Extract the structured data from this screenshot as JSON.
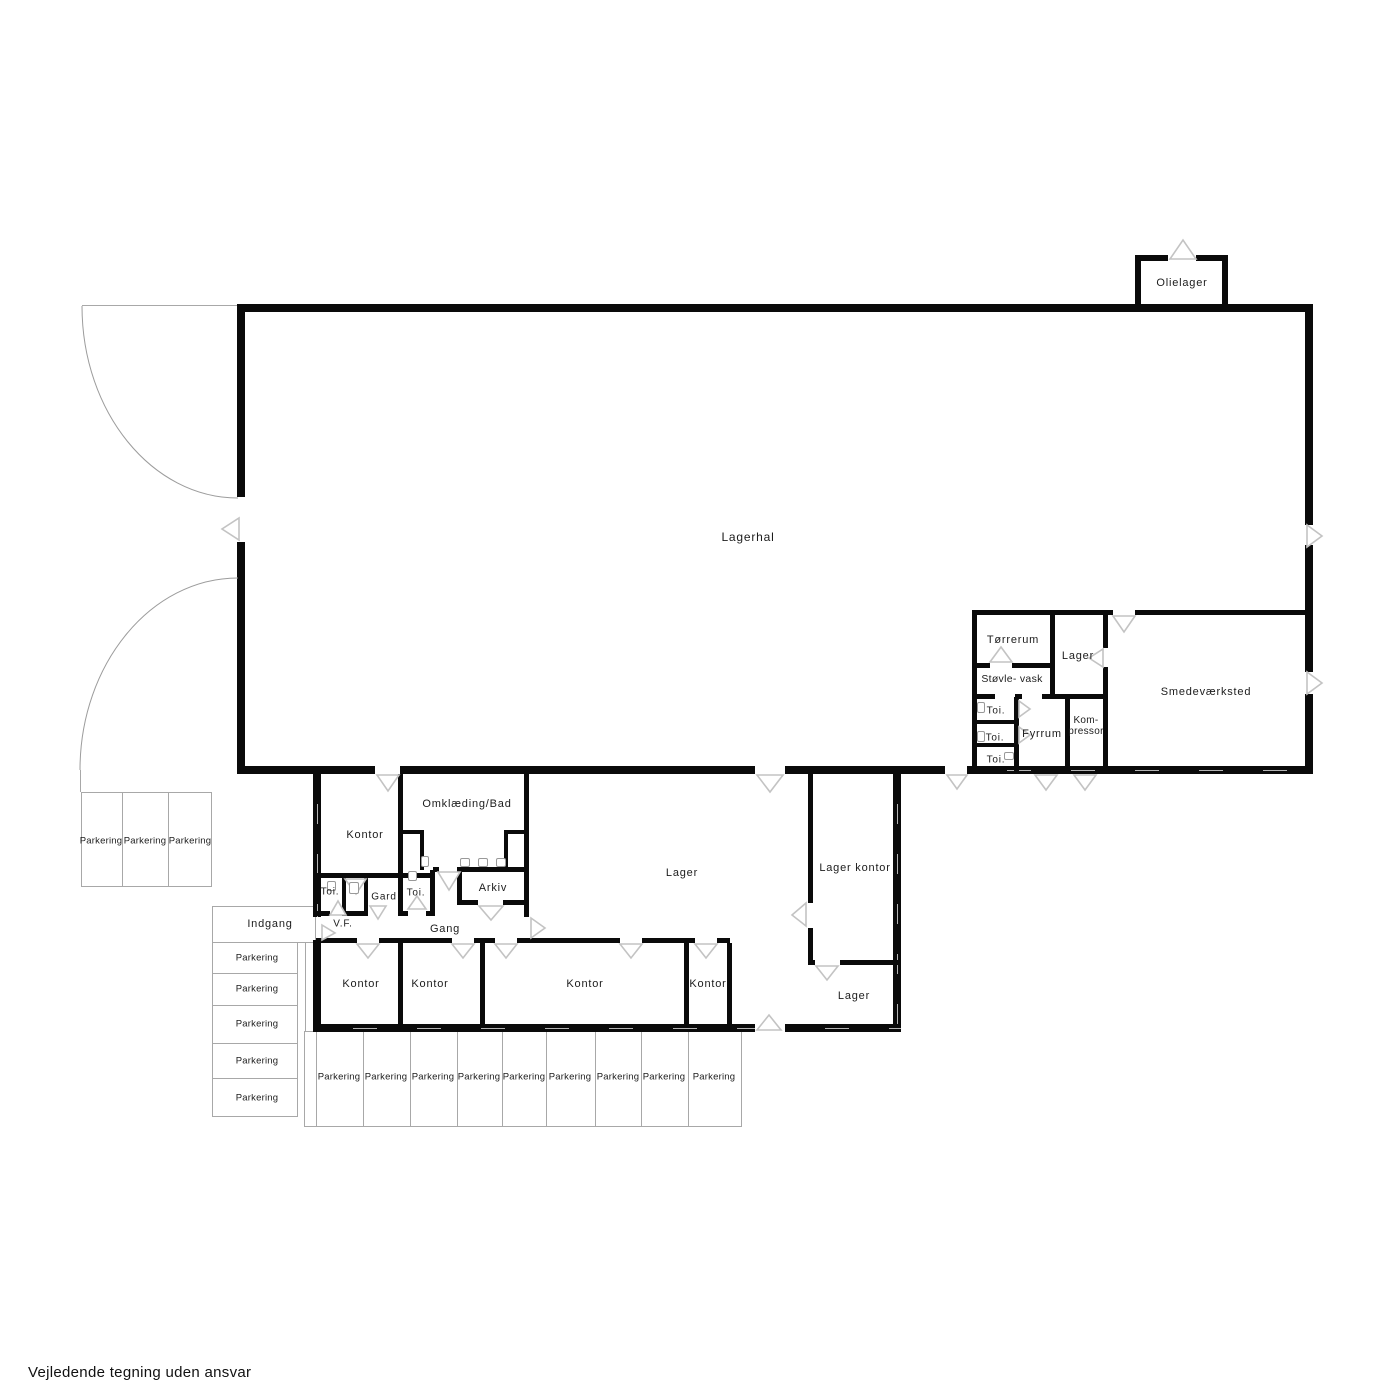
{
  "plan": {
    "footer_disclaimer": "Vejledende tegning uden ansvar",
    "colors": {
      "wall": "#0a0a0a",
      "thin_line": "#a8a8a8",
      "door_symbol": "#c3c3c3",
      "text": "#1c1c1c",
      "background": "#ffffff"
    },
    "rooms": {
      "lagerhal": "Lagerhal",
      "olielager": "Olielager",
      "torrerum": "Tørrerum",
      "lager_se": "Lager",
      "stovlevask": "Støvle- vask",
      "smedevaerksted": "Smedeværksted",
      "toi_se_1": "Toi.",
      "toi_se_2": "Toi.",
      "toi_se_3": "Toi.",
      "fyrrum": "Fyrrum",
      "kompressor": [
        "Kom-",
        "pressor"
      ],
      "kontor_nw": "Kontor",
      "omklaedning_bad": "Omklæding/Bad",
      "toi_w_1": "Toi.",
      "gard": "Gard",
      "toi_w_2": "Toi.",
      "arkiv": "Arkiv",
      "vf": "V.F.",
      "gang": "Gang",
      "lager_mid": "Lager",
      "lager_kontor": "Lager kontor",
      "lager_syd": "Lager",
      "kontor_1": "Kontor",
      "kontor_2": "Kontor",
      "kontor_3": "Kontor",
      "kontor_4": "Kontor"
    },
    "site": {
      "indgang": "Indgang",
      "parking_west": [
        "Parkering",
        "Parkering",
        "Parkering"
      ],
      "parking_mid": [
        "Parkering",
        "Parkering",
        "Parkering",
        "Parkering",
        "Parkering"
      ],
      "parking_south": [
        "Parkering",
        "Parkering",
        "Parkering",
        "Parkering",
        "Parkering",
        "Parkering",
        "Parkering",
        "Parkering",
        "Parkering"
      ]
    },
    "icons": {
      "door_swing": "open triangle door-swing symbol",
      "gate_swing": "quarter-circle gate swing arc",
      "fixture": "small sanitary fixture outline"
    }
  }
}
